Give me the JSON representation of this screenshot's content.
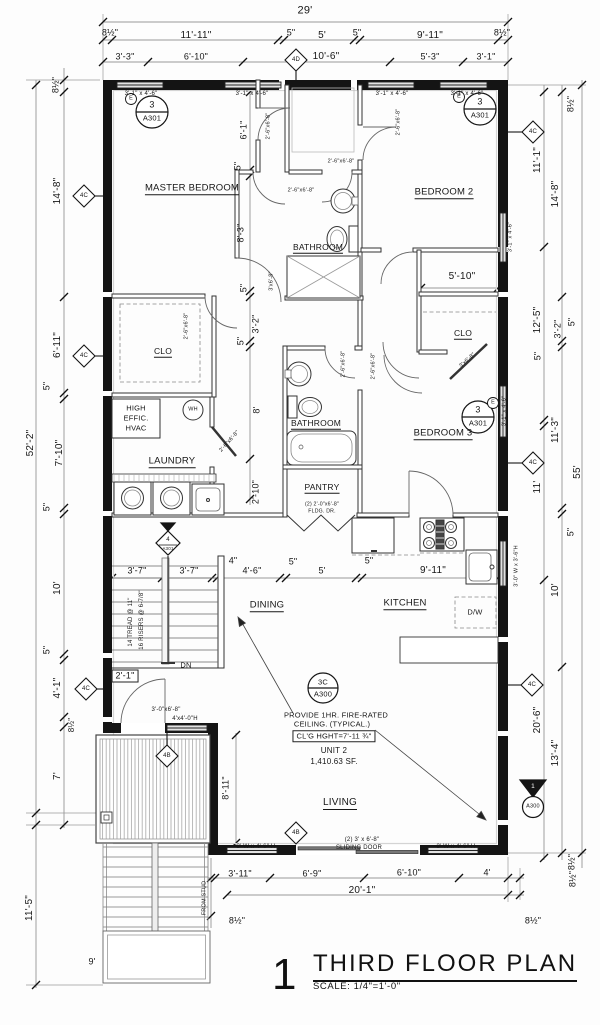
{
  "drawing": {
    "number": "1",
    "title": "THIRD FLOOR PLAN",
    "scale": "SCALE: 1/4\"=1'-0\""
  },
  "colors": {
    "ink": "#161616",
    "wall": "#141414",
    "dim": "#666666",
    "hatch": "#9a9a9a",
    "window_fill": "#e2e2e2"
  },
  "unit": {
    "name": "UNIT 2",
    "area": "1,410.63 SF.",
    "ceiling_note": "PROVIDE 1HR. FIRE-RATED CEILING. (TYPICAL.)",
    "ceiling_height": "CL'G HGHT=7'-11 ¾\""
  },
  "rooms": [
    "MASTER BEDROOM",
    "BEDROOM 2",
    "BEDROOM 3",
    "BATHROOM",
    "BATHROOM",
    "CLO",
    "CLO",
    "LAUNDRY",
    "PANTRY",
    "DINING",
    "KITCHEN",
    "LIVING"
  ],
  "plan": {
    "labels": [
      {
        "n": "dim-overall-width",
        "t": "29'",
        "x": 305,
        "y": 11,
        "s": 11
      },
      {
        "n": "dim",
        "t": "8½\"",
        "x": 110,
        "y": 33
      },
      {
        "n": "dim",
        "t": "11'-11\"",
        "x": 196,
        "y": 36,
        "s": 10
      },
      {
        "n": "dim",
        "t": "5\"",
        "x": 291,
        "y": 33
      },
      {
        "n": "dim",
        "t": "5'",
        "x": 322,
        "y": 36,
        "s": 10
      },
      {
        "n": "dim",
        "t": "5\"",
        "x": 357,
        "y": 33
      },
      {
        "n": "dim",
        "t": "9'-11\"",
        "x": 430,
        "y": 36,
        "s": 10
      },
      {
        "n": "dim",
        "t": "8½\"",
        "x": 502,
        "y": 33
      },
      {
        "n": "dim",
        "t": "3'-3\"",
        "x": 125,
        "y": 57
      },
      {
        "n": "dim",
        "t": "6'-10\"",
        "x": 196,
        "y": 57
      },
      {
        "n": "dim",
        "t": "10'-6\"",
        "x": 326,
        "y": 57,
        "s": 10
      },
      {
        "n": "dim",
        "t": "5'-3\"",
        "x": 430,
        "y": 57
      },
      {
        "n": "dim",
        "t": "3'-1\"",
        "x": 486,
        "y": 57
      },
      {
        "n": "keynote-diamond-label",
        "t": "4D",
        "x": 296,
        "y": 60,
        "s": 6
      },
      {
        "n": "window-label",
        "t": "3'-1\" x 4'-6\"",
        "x": 141,
        "y": 94,
        "s": 6
      },
      {
        "n": "window-label",
        "t": "3'-1\" x 4'-6\"",
        "x": 252,
        "y": 94,
        "s": 6
      },
      {
        "n": "window-label",
        "t": "3'-1\" x 4'-6\"",
        "x": 392,
        "y": 94,
        "s": 6
      },
      {
        "n": "window-label",
        "t": "3'-1\" x 4'-6\"",
        "x": 467,
        "y": 94,
        "s": 6
      },
      {
        "n": "tag-number",
        "t": "3",
        "x": 152,
        "y": 105,
        "s": 9
      },
      {
        "n": "tag-sheet",
        "t": "A301",
        "x": 152,
        "y": 118,
        "s": 7.5
      },
      {
        "n": "tag-existing",
        "t": "E",
        "x": 131,
        "y": 99,
        "s": 5.5
      },
      {
        "n": "tag-number",
        "t": "3",
        "x": 480,
        "y": 102,
        "s": 9
      },
      {
        "n": "tag-sheet",
        "t": "A301",
        "x": 480,
        "y": 115,
        "s": 7.5
      },
      {
        "n": "tag-existing",
        "t": "E",
        "x": 459,
        "y": 97,
        "s": 5.5
      },
      {
        "n": "tag-number",
        "t": "3",
        "x": 478,
        "y": 410,
        "s": 9
      },
      {
        "n": "tag-sheet",
        "t": "A301",
        "x": 478,
        "y": 423,
        "s": 7.5
      },
      {
        "n": "tag-existing",
        "t": "E",
        "x": 493,
        "y": 403,
        "s": 5.5
      },
      {
        "n": "tag-number",
        "t": "3C",
        "x": 323,
        "y": 682,
        "s": 7.5
      },
      {
        "n": "tag-sheet",
        "t": "A300",
        "x": 323,
        "y": 694,
        "s": 7.5
      },
      {
        "n": "room-label-master-bedroom",
        "t": "MASTER BEDROOM",
        "x": 192,
        "y": 189,
        "s": 9.5,
        "u": 1
      },
      {
        "n": "room-label-bedroom-2",
        "t": "BEDROOM 2",
        "x": 444,
        "y": 193,
        "s": 9.5,
        "u": 1
      },
      {
        "n": "room-label-bathroom-upper",
        "t": "BATHROOM",
        "x": 318,
        "y": 248,
        "s": 8.5,
        "u": 1
      },
      {
        "n": "room-label-closet-left",
        "t": "CLO",
        "x": 163,
        "y": 352,
        "s": 8.5,
        "u": 1
      },
      {
        "n": "room-label-closet-right",
        "t": "CLO",
        "x": 463,
        "y": 334,
        "s": 8.5,
        "u": 1
      },
      {
        "n": "room-label-laundry",
        "t": "LAUNDRY",
        "x": 172,
        "y": 462,
        "s": 9.5,
        "u": 1
      },
      {
        "n": "room-label-bathroom-lower",
        "t": "BATHROOM",
        "x": 316,
        "y": 424,
        "s": 8.5,
        "u": 1
      },
      {
        "n": "room-label-pantry",
        "t": "PANTRY",
        "x": 322,
        "y": 488,
        "s": 8.5,
        "u": 1
      },
      {
        "n": "room-label-bedroom-3",
        "t": "BEDROOM 3",
        "x": 443,
        "y": 434,
        "s": 9.5,
        "u": 1
      },
      {
        "n": "room-label-dining",
        "t": "DINING",
        "x": 267,
        "y": 606,
        "s": 9.5,
        "u": 1
      },
      {
        "n": "room-label-kitchen",
        "t": "KITCHEN",
        "x": 405,
        "y": 604,
        "s": 9.5,
        "u": 1
      },
      {
        "n": "room-label-living",
        "t": "LIVING",
        "x": 340,
        "y": 804,
        "s": 10,
        "u": 1
      },
      {
        "n": "appliance-label-dishwasher",
        "t": "D/W",
        "x": 475,
        "y": 612,
        "s": 7.5
      },
      {
        "n": "fixture-label-water-heater",
        "t": "WH",
        "x": 193,
        "y": 410,
        "s": 5.5
      },
      {
        "n": "stair-label-down",
        "t": "DN",
        "x": 186,
        "y": 665,
        "s": 7.5
      },
      {
        "n": "hvac-label-1",
        "t": "HIGH",
        "x": 136,
        "y": 408,
        "s": 7.5
      },
      {
        "n": "hvac-label-2",
        "t": "EFFIC.",
        "x": 136,
        "y": 418,
        "s": 7.5
      },
      {
        "n": "hvac-label-3",
        "t": "HVAC",
        "x": 136,
        "y": 428,
        "s": 7.5
      },
      {
        "n": "note-fire-rated-1",
        "t": "PROVIDE 1HR. FIRE-RATED",
        "x": 336,
        "y": 715,
        "s": 7.5
      },
      {
        "n": "note-fire-rated-2",
        "t": "CEILING. (TYPICAL.)",
        "x": 332,
        "y": 724,
        "s": 7.5
      },
      {
        "n": "note-ceiling-height",
        "t": "CL'G HGHT=7'-11 ¾\"",
        "x": 334,
        "y": 736,
        "s": 7.5,
        "b": 1
      },
      {
        "n": "note-unit-number",
        "t": "UNIT 2",
        "x": 334,
        "y": 751,
        "s": 8
      },
      {
        "n": "note-unit-area",
        "t": "1,410.63 SF.",
        "x": 334,
        "y": 762,
        "s": 8
      },
      {
        "n": "door-label",
        "t": "2'-6\"x6'-8\"",
        "x": 341,
        "y": 162,
        "s": 5.5
      },
      {
        "n": "door-label",
        "t": "2'-6\"x6'-8\"",
        "x": 301,
        "y": 191,
        "s": 5.5
      },
      {
        "n": "door-label",
        "t": "2'-6\"x6'-8\"",
        "x": 269,
        "y": 126,
        "s": 5.5,
        "r": -90
      },
      {
        "n": "door-label",
        "t": "2'-6\"x6'-8\"",
        "x": 399,
        "y": 122,
        "s": 5.5,
        "r": -90
      },
      {
        "n": "door-label",
        "t": "2'-6\"x6'-8\"",
        "x": 187,
        "y": 326,
        "s": 5.5,
        "r": -90
      },
      {
        "n": "door-label",
        "t": "2'-6\"x6'-8\"",
        "x": 344,
        "y": 364,
        "s": 5.5,
        "r": -90
      },
      {
        "n": "door-label",
        "t": "2'-6\"x6'-8\"",
        "x": 374,
        "y": 366,
        "s": 5.5,
        "r": -90
      },
      {
        "n": "door-label",
        "t": "3'x6'-8\"",
        "x": 272,
        "y": 281,
        "s": 5.5,
        "r": -90
      },
      {
        "n": "door-label",
        "t": "2'-6\"x6'-8\"",
        "x": 230,
        "y": 442,
        "s": 5.5,
        "r": -48
      },
      {
        "n": "door-label",
        "t": "3'x6'-8\"",
        "x": 468,
        "y": 361,
        "s": 5.5,
        "r": -42
      },
      {
        "n": "door-label-pantry-1",
        "t": "(2) 2'-0\"x6'-8\"",
        "x": 322,
        "y": 505,
        "s": 5.2
      },
      {
        "n": "door-label-pantry-2",
        "t": "FLDG. DR.",
        "x": 322,
        "y": 512,
        "s": 5.2
      },
      {
        "n": "door-label-deck",
        "t": "3'-0\"x6'-8\"",
        "x": 166,
        "y": 710,
        "s": 6
      },
      {
        "n": "window-label",
        "t": "4'x4'-0\"H",
        "x": 185,
        "y": 719,
        "s": 6
      },
      {
        "n": "window-label",
        "t": "3' W x 4'-6\" H",
        "x": 256,
        "y": 847,
        "s": 6
      },
      {
        "n": "door-label-sliding-1",
        "t": "(2) 3' x 6'-8\"",
        "x": 362,
        "y": 840,
        "s": 6
      },
      {
        "n": "door-label-sliding-2",
        "t": "SLIDING DOOR",
        "x": 359,
        "y": 848,
        "s": 6
      },
      {
        "n": "window-label",
        "t": "3' W x 4'-6\" H",
        "x": 456,
        "y": 847,
        "s": 6
      },
      {
        "n": "window-label",
        "t": "3'-1\" x 4'-6\"",
        "x": 511,
        "y": 237,
        "s": 5.5,
        "r": -90
      },
      {
        "n": "window-label",
        "t": "3'-1\" x 4'-6\"",
        "x": 505,
        "y": 411,
        "s": 5.5,
        "r": -90
      },
      {
        "n": "window-label",
        "t": "3'-0\" W x 3'-6\"H",
        "x": 517,
        "y": 566,
        "s": 5.5,
        "r": -90
      },
      {
        "n": "dim",
        "t": "8½\"",
        "x": 56,
        "y": 85,
        "r": -90
      },
      {
        "n": "dim",
        "t": "14'-8\"",
        "x": 58,
        "y": 191,
        "r": -90,
        "s": 10
      },
      {
        "n": "dim",
        "t": "6'-11\"",
        "x": 58,
        "y": 345,
        "r": -90,
        "s": 10
      },
      {
        "n": "dim",
        "t": "5\"",
        "x": 47,
        "y": 386,
        "r": -90
      },
      {
        "n": "dim",
        "t": "7'-10\"",
        "x": 60,
        "y": 453,
        "r": -90,
        "s": 10
      },
      {
        "n": "dim",
        "t": "5\"",
        "x": 47,
        "y": 507,
        "r": -90
      },
      {
        "n": "dim",
        "t": "10'",
        "x": 58,
        "y": 588,
        "r": -90,
        "s": 10
      },
      {
        "n": "dim",
        "t": "5\"",
        "x": 47,
        "y": 650,
        "r": -90
      },
      {
        "n": "dim",
        "t": "4'-1\"",
        "x": 58,
        "y": 688,
        "r": -90,
        "s": 10
      },
      {
        "n": "dim",
        "t": "8½\"",
        "x": 72,
        "y": 725,
        "r": -90,
        "s": 8
      },
      {
        "n": "dim",
        "t": "7'",
        "x": 58,
        "y": 776,
        "r": -90,
        "s": 10
      },
      {
        "n": "dim",
        "t": "52'-2\"",
        "x": 31,
        "y": 443,
        "r": -90,
        "s": 10
      },
      {
        "n": "dim",
        "t": "11'-5\"",
        "x": 30,
        "y": 908,
        "r": -90,
        "s": 10
      },
      {
        "n": "dim",
        "t": "8½\"",
        "x": 571,
        "y": 104,
        "r": -90
      },
      {
        "n": "dim",
        "t": "11'-1\"",
        "x": 538,
        "y": 160,
        "r": -90,
        "s": 10
      },
      {
        "n": "dim",
        "t": "14'-8\"",
        "x": 556,
        "y": 194,
        "r": -90,
        "s": 10
      },
      {
        "n": "dim",
        "t": "12'-5\"",
        "x": 538,
        "y": 320,
        "r": -90,
        "s": 10
      },
      {
        "n": "dim",
        "t": "3'-2\"",
        "x": 558,
        "y": 329,
        "r": -90
      },
      {
        "n": "dim",
        "t": "5\"",
        "x": 572,
        "y": 322,
        "r": -90
      },
      {
        "n": "dim",
        "t": "5\"",
        "x": 538,
        "y": 356,
        "r": -90
      },
      {
        "n": "dim",
        "t": "11'-3\"",
        "x": 556,
        "y": 430,
        "r": -90,
        "s": 10
      },
      {
        "n": "dim",
        "t": "55'",
        "x": 578,
        "y": 472,
        "r": -90,
        "s": 10
      },
      {
        "n": "dim",
        "t": "11'",
        "x": 538,
        "y": 487,
        "r": -90,
        "s": 10
      },
      {
        "n": "dim",
        "t": "5\"",
        "x": 571,
        "y": 532,
        "r": -90
      },
      {
        "n": "dim",
        "t": "10'",
        "x": 556,
        "y": 590,
        "r": -90,
        "s": 10
      },
      {
        "n": "dim",
        "t": "20'-6\"",
        "x": 538,
        "y": 720,
        "r": -90,
        "s": 10
      },
      {
        "n": "dim",
        "t": "13'-4\"",
        "x": 556,
        "y": 753,
        "r": -90,
        "s": 10
      },
      {
        "n": "dim",
        "t": "8½\"",
        "x": 572,
        "y": 862,
        "r": -90
      },
      {
        "n": "dim",
        "t": "6'-1\"",
        "x": 244,
        "y": 130,
        "r": -90
      },
      {
        "n": "dim",
        "t": "5\"",
        "x": 238,
        "y": 166,
        "r": -90
      },
      {
        "n": "dim",
        "t": "8'-3\"",
        "x": 241,
        "y": 233,
        "r": -90
      },
      {
        "n": "dim",
        "t": "5\"",
        "x": 244,
        "y": 288,
        "r": -90
      },
      {
        "n": "dim",
        "t": "3'-2\"",
        "x": 256,
        "y": 324,
        "r": -90
      },
      {
        "n": "dim",
        "t": "5\"",
        "x": 241,
        "y": 341,
        "r": -90
      },
      {
        "n": "dim",
        "t": "8'",
        "x": 257,
        "y": 410,
        "r": -90
      },
      {
        "n": "dim",
        "t": "2'-10\"",
        "x": 256,
        "y": 492,
        "r": -90
      },
      {
        "n": "dim",
        "t": "5'-10\"",
        "x": 462,
        "y": 277,
        "s": 10
      },
      {
        "n": "dim",
        "t": "3'-7\"",
        "x": 137,
        "y": 571
      },
      {
        "n": "dim",
        "t": "3'-7\"",
        "x": 189,
        "y": 571
      },
      {
        "n": "dim",
        "t": "4\"",
        "x": 233,
        "y": 561
      },
      {
        "n": "dim",
        "t": "4'-6\"",
        "x": 252,
        "y": 571
      },
      {
        "n": "dim",
        "t": "5\"",
        "x": 293,
        "y": 562
      },
      {
        "n": "dim",
        "t": "5'",
        "x": 322,
        "y": 571
      },
      {
        "n": "dim",
        "t": "5\"",
        "x": 369,
        "y": 561
      },
      {
        "n": "dim",
        "t": "9'-11\"",
        "x": 433,
        "y": 571,
        "s": 10
      },
      {
        "n": "stair-note",
        "t": "14 TREAD @ 11\"",
        "x": 131,
        "y": 622,
        "r": -90,
        "s": 6
      },
      {
        "n": "stair-note",
        "t": "16 RISERS @ 6-7/8\"",
        "x": 142,
        "y": 620,
        "r": -90,
        "s": 6
      },
      {
        "n": "dim",
        "t": "2'-1\"",
        "x": 125,
        "y": 676,
        "b": 1
      },
      {
        "n": "dim",
        "t": "8'-11\"",
        "x": 226,
        "y": 788,
        "r": -90
      },
      {
        "n": "dim",
        "t": "3'-11\"",
        "x": 240,
        "y": 874
      },
      {
        "n": "dim",
        "t": "6'-9\"",
        "x": 312,
        "y": 874
      },
      {
        "n": "dim",
        "t": "6'-10\"",
        "x": 409,
        "y": 873
      },
      {
        "n": "dim",
        "t": "4'",
        "x": 487,
        "y": 873
      },
      {
        "n": "dim",
        "t": "20'-1\"",
        "x": 362,
        "y": 891,
        "s": 10
      },
      {
        "n": "dim",
        "t": "8½\"",
        "x": 533,
        "y": 921
      },
      {
        "n": "dim",
        "t": "8½\"",
        "x": 573,
        "y": 879,
        "r": -90
      },
      {
        "n": "dim",
        "t": "8½\"",
        "x": 237,
        "y": 921
      },
      {
        "n": "dim-note",
        "t": "FROM STUD",
        "x": 205,
        "y": 898,
        "r": -90,
        "s": 5.5
      },
      {
        "n": "dim",
        "t": "9'",
        "x": 92,
        "y": 962
      },
      {
        "n": "keynote-diamond-label",
        "t": "4C",
        "x": 84,
        "y": 196,
        "s": 6
      },
      {
        "n": "keynote-diamond-label",
        "t": "4C",
        "x": 84,
        "y": 356,
        "s": 6
      },
      {
        "n": "keynote-diamond-label",
        "t": "4C",
        "x": 86,
        "y": 689,
        "s": 6
      },
      {
        "n": "keynote-diamond-label",
        "t": "4C",
        "x": 533,
        "y": 132,
        "s": 6
      },
      {
        "n": "keynote-diamond-label",
        "t": "4C",
        "x": 533,
        "y": 463,
        "s": 6
      },
      {
        "n": "keynote-diamond-label",
        "t": "4C",
        "x": 532,
        "y": 685,
        "s": 6
      },
      {
        "n": "keynote-diamond-label",
        "t": "4B",
        "x": 167,
        "y": 756,
        "s": 6
      },
      {
        "n": "keynote-diamond-label",
        "t": "4B",
        "x": 296,
        "y": 833,
        "s": 6
      },
      {
        "n": "section-marker-number",
        "t": "4",
        "x": 168,
        "y": 540,
        "s": 6
      },
      {
        "n": "section-marker-sheet",
        "t": "A301",
        "x": 168,
        "y": 549,
        "s": 4.5
      },
      {
        "n": "section-marker-number",
        "t": "1",
        "x": 533,
        "y": 787,
        "s": 6.5,
        "c": "#ffffff"
      },
      {
        "n": "section-marker-sheet",
        "t": "A300",
        "x": 533,
        "y": 807,
        "s": 5.5
      }
    ]
  }
}
